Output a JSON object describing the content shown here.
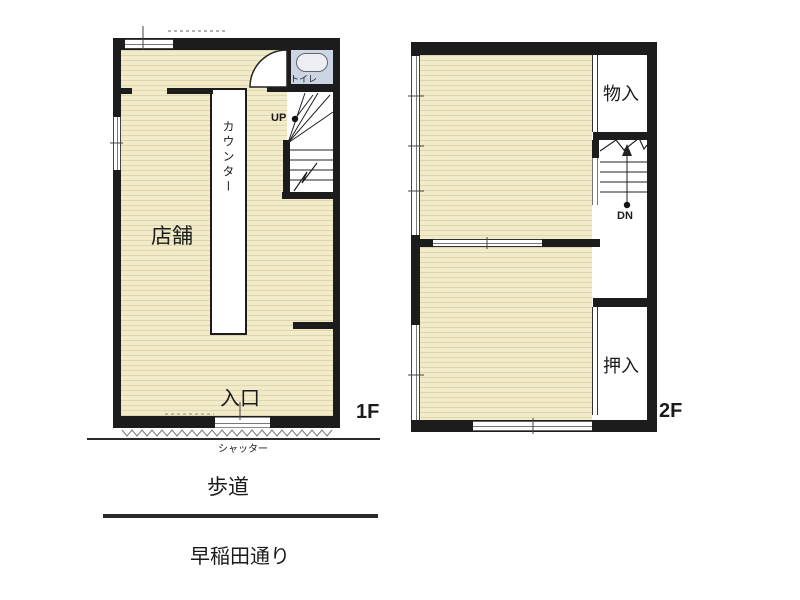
{
  "floor1": {
    "label": "1F",
    "shop": "店舗",
    "counter": "カウンター",
    "toilet": "トイレ",
    "stairs_up": "UP",
    "entrance": "入口",
    "shutter": "シャッター"
  },
  "floor2": {
    "label": "2F",
    "storage": "物入",
    "closet": "押入",
    "stairs_down": "DN"
  },
  "street": {
    "sidewalk": "歩道",
    "road": "早稲田通り"
  },
  "colors": {
    "background": "#ffffff",
    "wall": "#1c1c1c",
    "floor_beige": "#f1ebc9",
    "floor_stripe": "#ded6ae",
    "toilet_floor": "#ccd5e3",
    "line": "#333333"
  }
}
